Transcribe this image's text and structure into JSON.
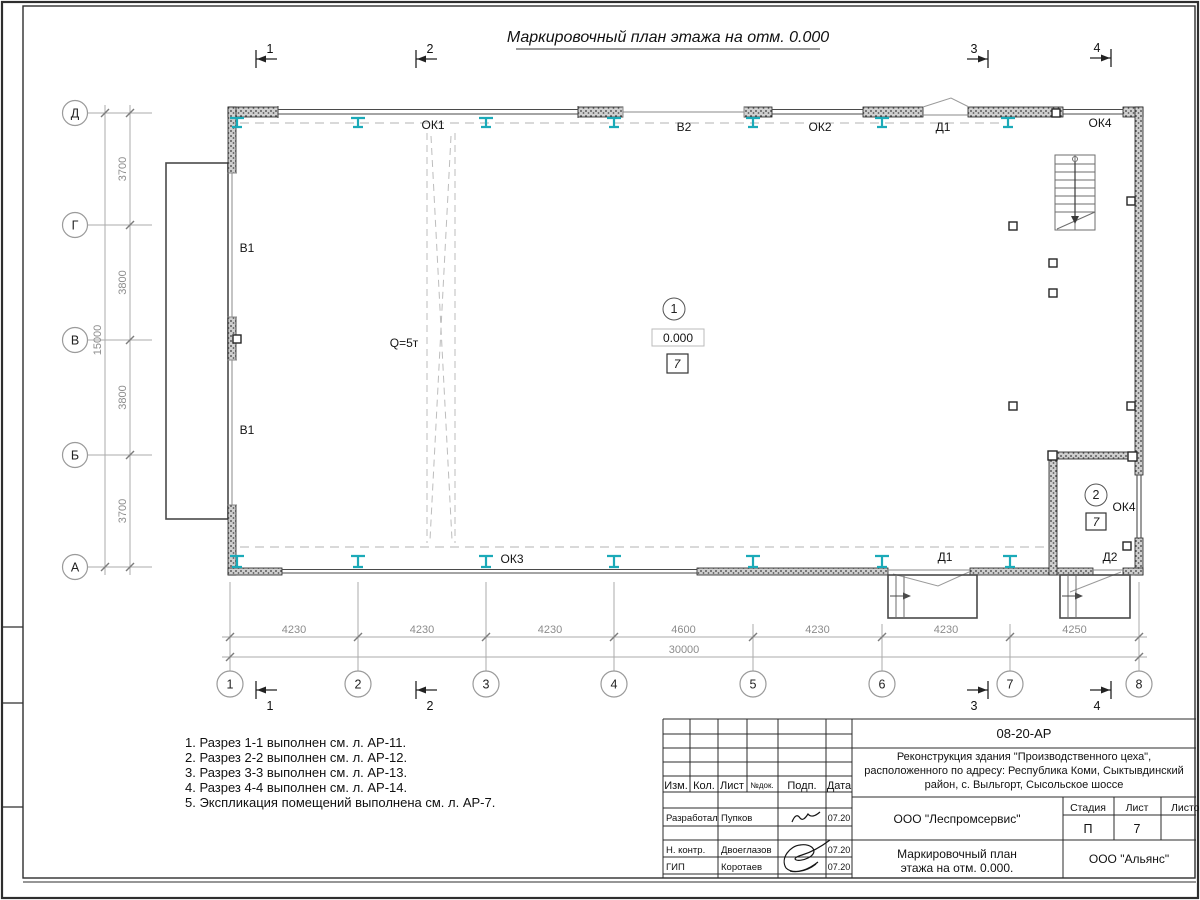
{
  "sheet": {
    "title": "Маркировочный план этажа на отм. 0.000"
  },
  "plan": {
    "row_axes": [
      "Д",
      "Г",
      "В",
      "Б",
      "А"
    ],
    "col_axes": [
      "1",
      "2",
      "3",
      "4",
      "5",
      "6",
      "7",
      "8"
    ],
    "dim_v": [
      "3700",
      "3800",
      "3800",
      "3700"
    ],
    "dim_v_total": "15000",
    "dim_h": [
      "4230",
      "4230",
      "4230",
      "4600",
      "4230",
      "4230",
      "4250"
    ],
    "dim_h_total": "30000",
    "marks": {
      "ok1": "ОК1",
      "ok2": "ОК2",
      "ok3": "ОК3",
      "ok4_top": "ОК4",
      "ok4_room": "ОК4",
      "v1_upper": "В1",
      "v1_lower": "В1",
      "v2": "В2",
      "d1_top": "Д1",
      "d1_bottom": "Д1",
      "d2": "Д2",
      "crane": "Q=5т"
    },
    "room_main": {
      "number": "1",
      "elevation": "0.000",
      "tag": "7"
    },
    "room_2": {
      "number": "2",
      "tag": "7"
    },
    "sections_top": [
      "1",
      "2",
      "3",
      "4"
    ],
    "sections_bottom": [
      "1",
      "2",
      "3",
      "4"
    ]
  },
  "notes": [
    "1. Разрез 1-1 выполнен см. л. АР-11.",
    "2. Разрез 2-2 выполнен см. л. АР-12.",
    "3. Разрез 3-3 выполнен см. л. АР-13.",
    "4. Разрез 4-4 выполнен см. л. АР-14.",
    "5. Экспликация помещений выполнена см. л. АР-7."
  ],
  "titleblock": {
    "doc_number": "08-20-АР",
    "project_line1": "Реконструкция здания \"Производственного цеха\",",
    "project_line2": "расположенного по адресу: Республика Коми, Сыктывдинский",
    "project_line3": "район, с. Выльгорт, Сысольское шоссе",
    "columns": {
      "izm": "Изм.",
      "kol": "Кол.",
      "list": "Лист",
      "ndoc": "№док.",
      "podp": "Подп.",
      "data": "Дата"
    },
    "rows": [
      {
        "role": "Разработал",
        "name": "Пупков",
        "date": "07.20"
      },
      {
        "role": "Н. контр.",
        "name": "Двоеглазов",
        "date": "07.20"
      },
      {
        "role": "ГИП",
        "name": "Коротаев",
        "date": "07.20"
      }
    ],
    "org": "ООО \"Леспромсервис\"",
    "stage_label": "Стадия",
    "sheet_label": "Лист",
    "sheets_label": "Листов",
    "stage": "П",
    "sheet_num": "7",
    "doc_title_line1": "Маркировочный план",
    "doc_title_line2": "этажа на отм. 0.000.",
    "contractor": "ООО \"Альянс\""
  },
  "colors": {
    "steel_column": "#1BAAB8",
    "dim_text": "#8c8c8c"
  }
}
